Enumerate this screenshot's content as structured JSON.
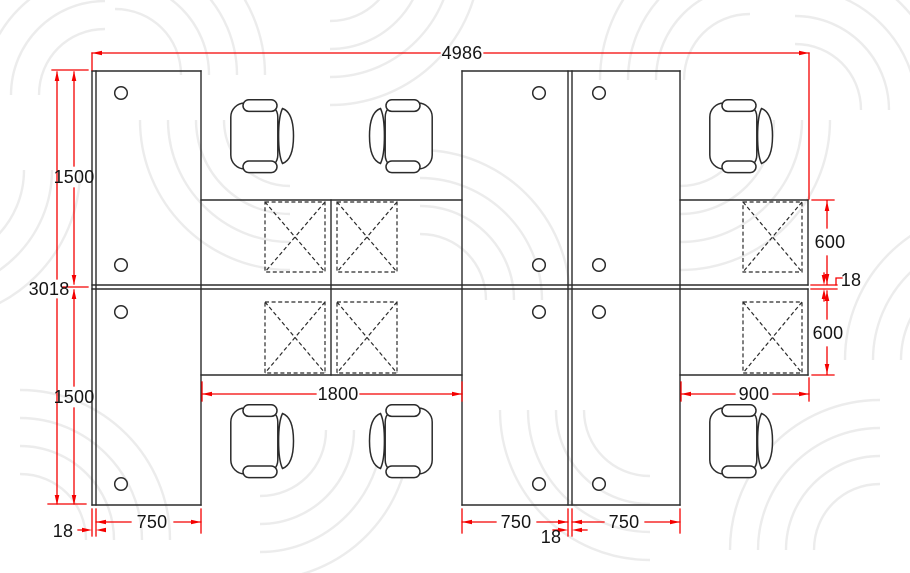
{
  "drawing": {
    "title": "Office workstation cluster floor plan (top view)",
    "view": "plan",
    "components": {
      "office_chairs": 6,
      "dashed_pedestal_units": 6,
      "cable_grommets": 12,
      "desk_panels": "back-to-back bench desks with end panels"
    },
    "style": {
      "dimension_color": "#f40000",
      "line_color": "#2b2b2b",
      "background": "#ffffff",
      "watermark_color": "#ececec"
    }
  },
  "dimensions": {
    "total_width": "4986",
    "total_depth": "3018",
    "left_return_depth_top": "1500",
    "left_return_depth_bottom": "1500",
    "panel_thickness_left": "18",
    "left_desk_width": "750",
    "center_run_length": "1800",
    "center_desk_width_left": "750",
    "center_panel_thickness": "18",
    "center_desk_width_right": "750",
    "right_run_length": "900",
    "desk_depth_top_right": "600",
    "worktop_gap_right": "18",
    "desk_depth_bottom_right": "600"
  }
}
